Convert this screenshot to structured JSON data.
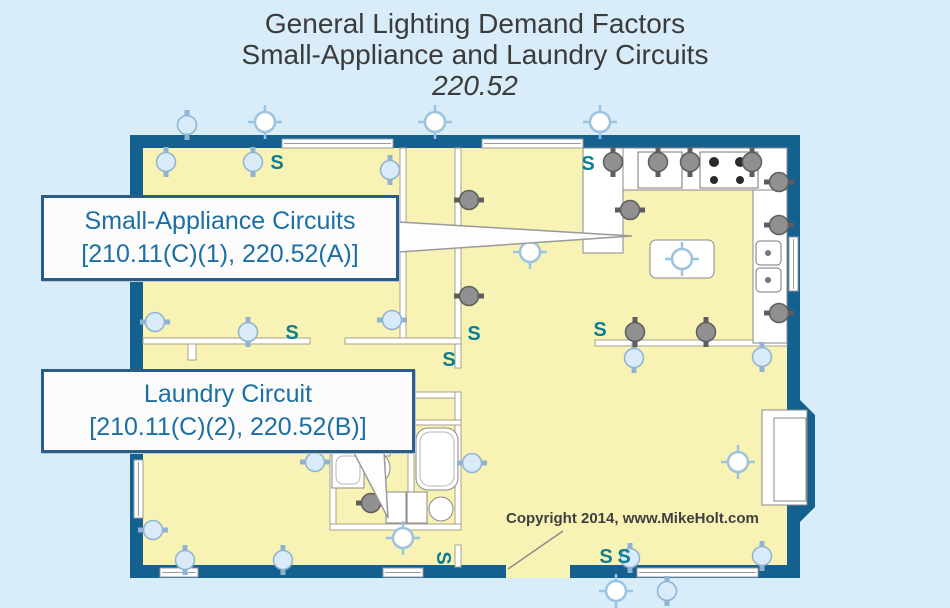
{
  "title": {
    "line1": "General Lighting Demand Factors",
    "line2": "Small-Appliance and Laundry Circuits",
    "line3": "220.52"
  },
  "callouts": {
    "small_appliance": {
      "title": "Small-Appliance Circuits",
      "reference": "[210.11(C)(1), 220.52(A)]"
    },
    "laundry": {
      "title": "Laundry Circuit",
      "reference": "[210.11(C)(2), 220.52(B)]"
    }
  },
  "copyright": "Copyright 2014, www.MikeHolt.com",
  "legend": {
    "switch_label": "S",
    "receptacle_general_meaning": "receptacle-outlet",
    "receptacle_appliance_meaning": "small-appliance-or-laundry-receptacle",
    "ceiling_light_meaning": "lighting-outlet"
  },
  "colors": {
    "background": "#d8edf9",
    "wall": "#14608f",
    "floor": "#f8f3b4",
    "callout_text": "#1c6fa4",
    "callout_border": "#2a5d88",
    "switch": "#0d7d93",
    "symbol_blue_fill": "#d9eaf8",
    "symbol_blue_stroke": "#8fb3d1",
    "symbol_gray_fill": "#909090",
    "symbol_gray_stroke": "#5d5d5d",
    "light_stroke": "#9cc3e0",
    "title_text": "#3b3b3b"
  },
  "plan": {
    "receptacles_general": [
      {
        "x": 166,
        "y": 162,
        "rot": 0
      },
      {
        "x": 253,
        "y": 162,
        "rot": 0
      },
      {
        "x": 390,
        "y": 170,
        "rot": 0
      },
      {
        "x": 187,
        "y": 125,
        "rot": 0
      },
      {
        "x": 392,
        "y": 320,
        "rot": 90
      },
      {
        "x": 155,
        "y": 322,
        "rot": 90
      },
      {
        "x": 248,
        "y": 332,
        "rot": 0
      },
      {
        "x": 634,
        "y": 358,
        "rot": 0
      },
      {
        "x": 762,
        "y": 357,
        "rot": 0
      },
      {
        "x": 315,
        "y": 462,
        "rot": 90
      },
      {
        "x": 472,
        "y": 463,
        "rot": 90
      },
      {
        "x": 153,
        "y": 530,
        "rot": 90
      },
      {
        "x": 185,
        "y": 560,
        "rot": 0
      },
      {
        "x": 283,
        "y": 560,
        "rot": 0
      },
      {
        "x": 630,
        "y": 558,
        "rot": 0
      },
      {
        "x": 762,
        "y": 556,
        "rot": 0
      },
      {
        "x": 667,
        "y": 591,
        "rot": 0
      }
    ],
    "receptacles_appliance": [
      {
        "x": 613,
        "y": 162,
        "rot": 0
      },
      {
        "x": 658,
        "y": 162,
        "rot": 0
      },
      {
        "x": 690,
        "y": 162,
        "rot": 0
      },
      {
        "x": 752,
        "y": 162,
        "rot": 0
      },
      {
        "x": 779,
        "y": 182,
        "rot": 90
      },
      {
        "x": 779,
        "y": 225,
        "rot": 90
      },
      {
        "x": 779,
        "y": 313,
        "rot": 90
      },
      {
        "x": 630,
        "y": 210,
        "rot": 90
      },
      {
        "x": 469,
        "y": 200,
        "rot": 90
      },
      {
        "x": 469,
        "y": 296,
        "rot": 90
      },
      {
        "x": 635,
        "y": 332,
        "rot": 0
      },
      {
        "x": 706,
        "y": 332,
        "rot": 0
      },
      {
        "x": 371,
        "y": 503,
        "rot": 90
      }
    ],
    "ceiling_lights": [
      {
        "x": 265,
        "y": 122
      },
      {
        "x": 435,
        "y": 122
      },
      {
        "x": 600,
        "y": 122
      },
      {
        "x": 530,
        "y": 252
      },
      {
        "x": 682,
        "y": 259
      },
      {
        "x": 738,
        "y": 462
      },
      {
        "x": 403,
        "y": 538
      },
      {
        "x": 616,
        "y": 591
      }
    ],
    "switches": [
      {
        "x": 277,
        "y": 163,
        "rot": 0
      },
      {
        "x": 588,
        "y": 164,
        "rot": 0
      },
      {
        "x": 292,
        "y": 333,
        "rot": 0
      },
      {
        "x": 449,
        "y": 360,
        "rot": 0
      },
      {
        "x": 474,
        "y": 334,
        "rot": 0
      },
      {
        "x": 600,
        "y": 330,
        "rot": 0
      },
      {
        "x": 606,
        "y": 557,
        "rot": 0
      },
      {
        "x": 624,
        "y": 557,
        "rot": 0
      },
      {
        "x": 443,
        "y": 558,
        "rot": 90
      }
    ]
  }
}
